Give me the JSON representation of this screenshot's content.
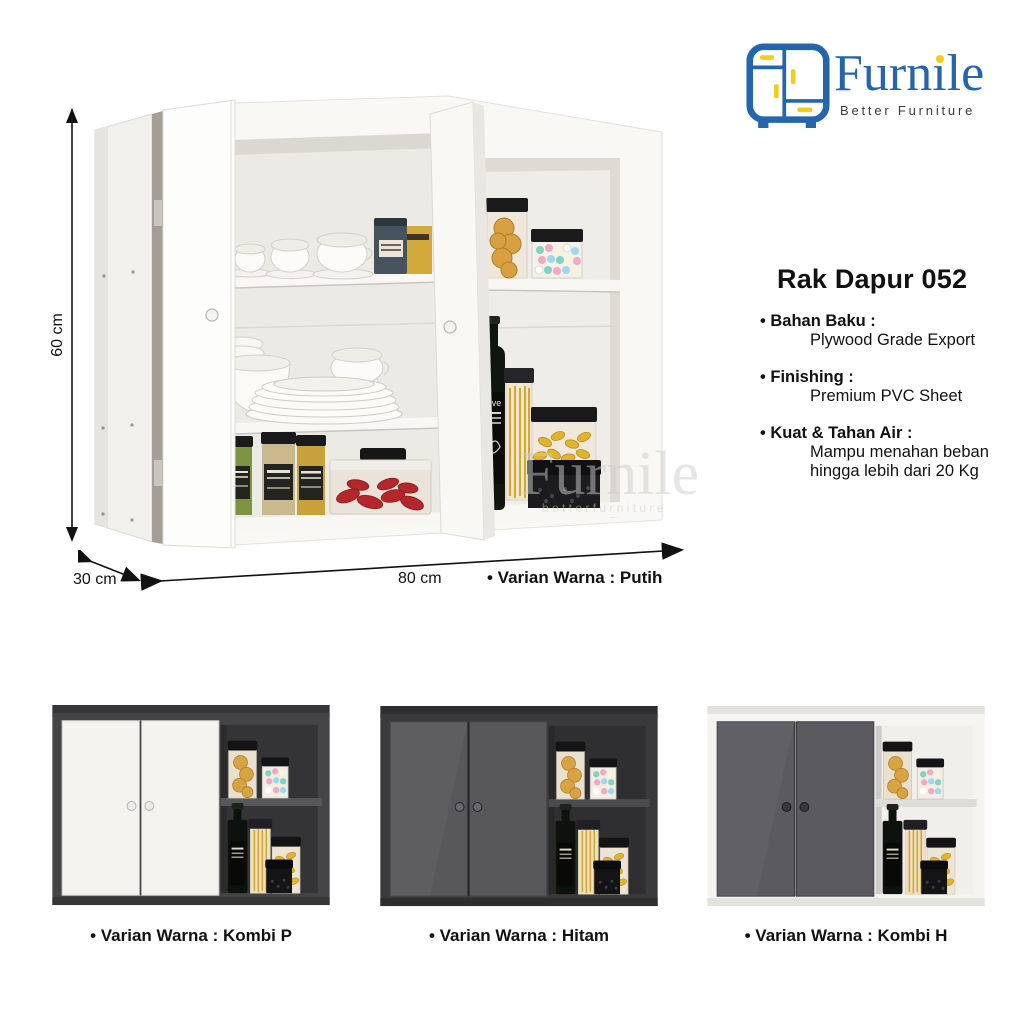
{
  "brand": {
    "name": "Furnile",
    "tagline": "Better Furniture"
  },
  "colors": {
    "brand_blue": "#2565ae",
    "brand_yellow": "#f3cd1a",
    "tagline_dark": "#3a3a3a",
    "text": "#111111",
    "watermark_gray": "#cdcdcd",
    "cabinet_white": "#f7f6f3",
    "cabinet_dark": "#414143"
  },
  "product": {
    "title": "Rak Dapur 052",
    "specs": [
      {
        "label": "• Bahan Baku :",
        "value": "Plywood Grade Export"
      },
      {
        "label": "• Finishing :",
        "value": "Premium PVC Sheet"
      },
      {
        "label": "• Kuat & Tahan Air :",
        "value": "Mampu menahan beban hingga lebih dari 20 Kg"
      }
    ]
  },
  "dimensions": {
    "height": "60 cm",
    "depth": "30 cm",
    "width": "80 cm"
  },
  "hero": {
    "variant_label": "• Varian Warna : Putih"
  },
  "watermark": {
    "name": "Furnile",
    "tagline": "b e t t e r   f u r n i t u r e"
  },
  "variants": [
    {
      "label": "• Varian Warna : Kombi P",
      "door": "#f4f3f0",
      "door_edge": "#d9d7d2",
      "body": "#454547",
      "body_top": "#37373a",
      "interior": "#343436",
      "shelf": "#57575a",
      "knob": "#ececea",
      "knob_edge": "#b4b4b0"
    },
    {
      "label": "• Varian Warna : Hitam",
      "door": "#58585b",
      "door_edge": "#454548",
      "body": "#3a3a3c",
      "body_top": "#2e2e30",
      "interior": "#2f2f31",
      "shelf": "#4b4b4e",
      "knob": "#68686c",
      "knob_edge": "#252528"
    },
    {
      "label": "• Varian Warna : Kombi H",
      "door": "#5b5b5f",
      "door_edge": "#48484c",
      "body": "#f5f4f1",
      "body_top": "#e4e2dd",
      "interior": "#f1efeb",
      "shelf": "#dedcd7",
      "knob": "#39393d",
      "knob_edge": "#1f1f23"
    }
  ]
}
